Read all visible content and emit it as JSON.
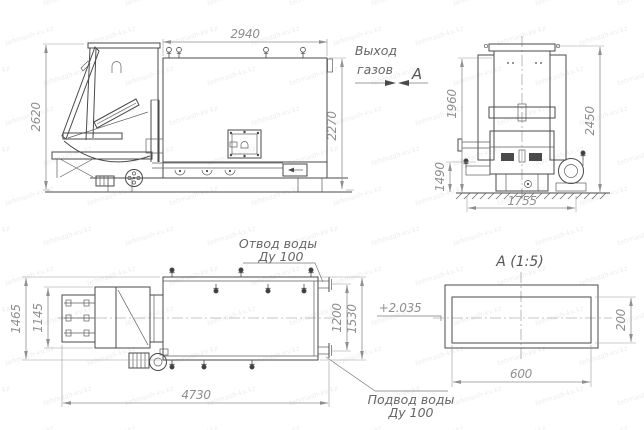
{
  "watermark": {
    "text": "tehmash-kv.kz"
  },
  "views": {
    "side": {
      "dim_width_top": "2940",
      "dim_height_overall": "2620",
      "dim_height_body": "2270",
      "gas_outlet_line1": "Выход",
      "gas_outlet_line2": "газов",
      "section_label": "А"
    },
    "front": {
      "dim_height_block": "1960",
      "dim_height_overall": "2450",
      "dim_height_base": "1490",
      "dim_width_base": "1755"
    },
    "plan": {
      "dim_depth_overall": "1465",
      "dim_depth_feeder": "1145",
      "dim_length_overall": "4730",
      "dim_nozzle_spacing": "1200",
      "dim_depth_body": "1530",
      "elevation_mark": "+2.035",
      "water_outlet_line1": "Отвод воды",
      "water_outlet_line2": "Ду 100",
      "water_inlet_line1": "Подвод воды",
      "water_inlet_line2": "Ду 100"
    },
    "detail": {
      "title": "А (1:5)",
      "dim_width": "600",
      "dim_height": "200"
    }
  }
}
